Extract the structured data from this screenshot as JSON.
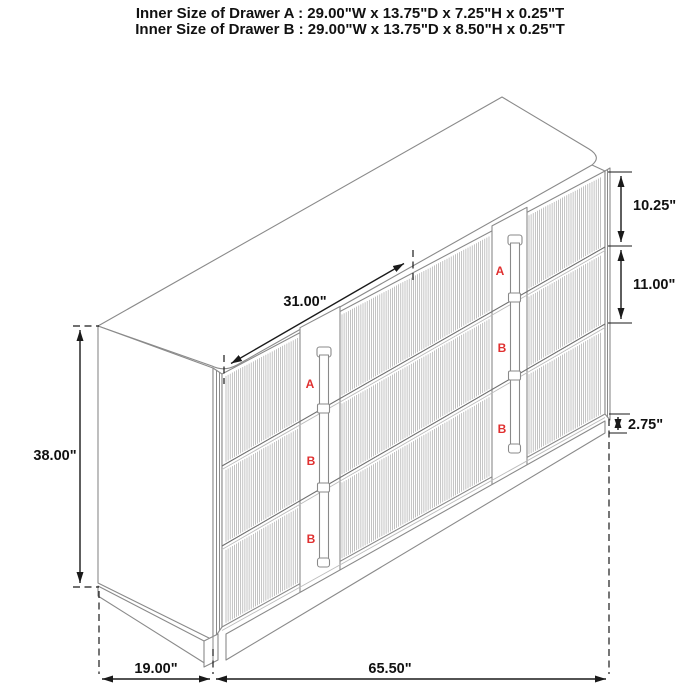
{
  "title": {
    "line1": "Inner Size of Drawer A : 29.00\"W x 13.75\"D x 7.25\"H x 0.25\"T",
    "line2": "Inner Size of Drawer B : 29.00\"W x 13.75\"D x 8.50\"H x 0.25\"T"
  },
  "dimensions": {
    "top_diagonal": "31.00\"",
    "overall_height": "38.00\"",
    "drawer_a_front_height": "10.25\"",
    "drawer_b_front_height": "11.00\"",
    "base_height": "2.75\"",
    "depth": "19.00\"",
    "overall_width": "65.50\""
  },
  "drawer_labels": {
    "a": "A",
    "b": "B"
  },
  "colors": {
    "label_red": "#e03030",
    "line_gray": "#8a8a8a",
    "dimension_black": "#1a1a1a"
  }
}
